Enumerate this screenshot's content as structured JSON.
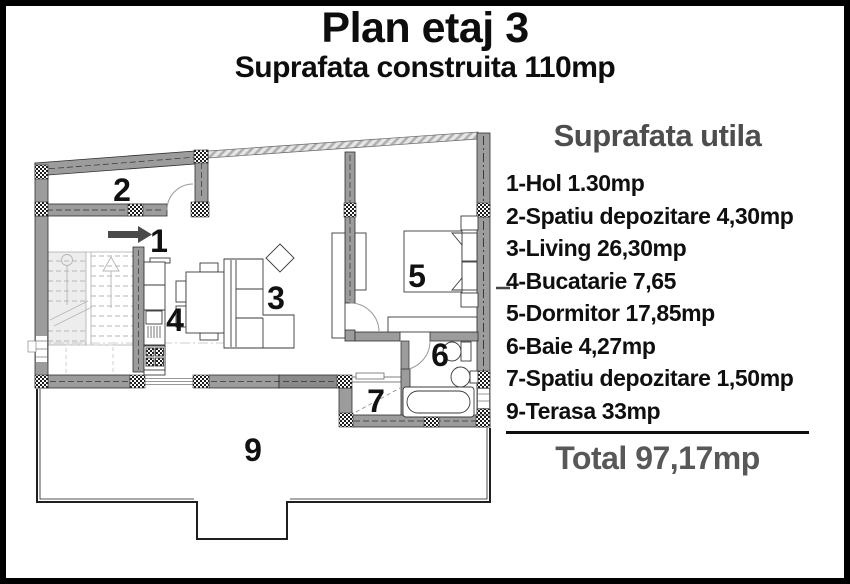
{
  "header": {
    "title": "Plan etaj 3",
    "subtitle": "Suprafata construita 110mp"
  },
  "legend": {
    "heading": "Suprafata utila",
    "items": [
      "1-Hol 1.30mp",
      "2-Spatiu depozitare 4,30mp",
      "3-Living 26,30mp",
      "4-Bucatarie 7,65",
      "5-Dormitor 17,85mp",
      "6-Baie 4,27mp",
      "7-Spatiu depozitare 1,50mp",
      "9-Terasa 33mp"
    ],
    "total": "Total 97,17mp"
  },
  "plan": {
    "room_labels": [
      "1",
      "2",
      "3",
      "4",
      "5",
      "6",
      "7",
      "9"
    ]
  },
  "colors": {
    "wall_gray": "#9c9c9c",
    "heading_gray": "#4d4d4d",
    "text_black": "#0d0d0d"
  }
}
